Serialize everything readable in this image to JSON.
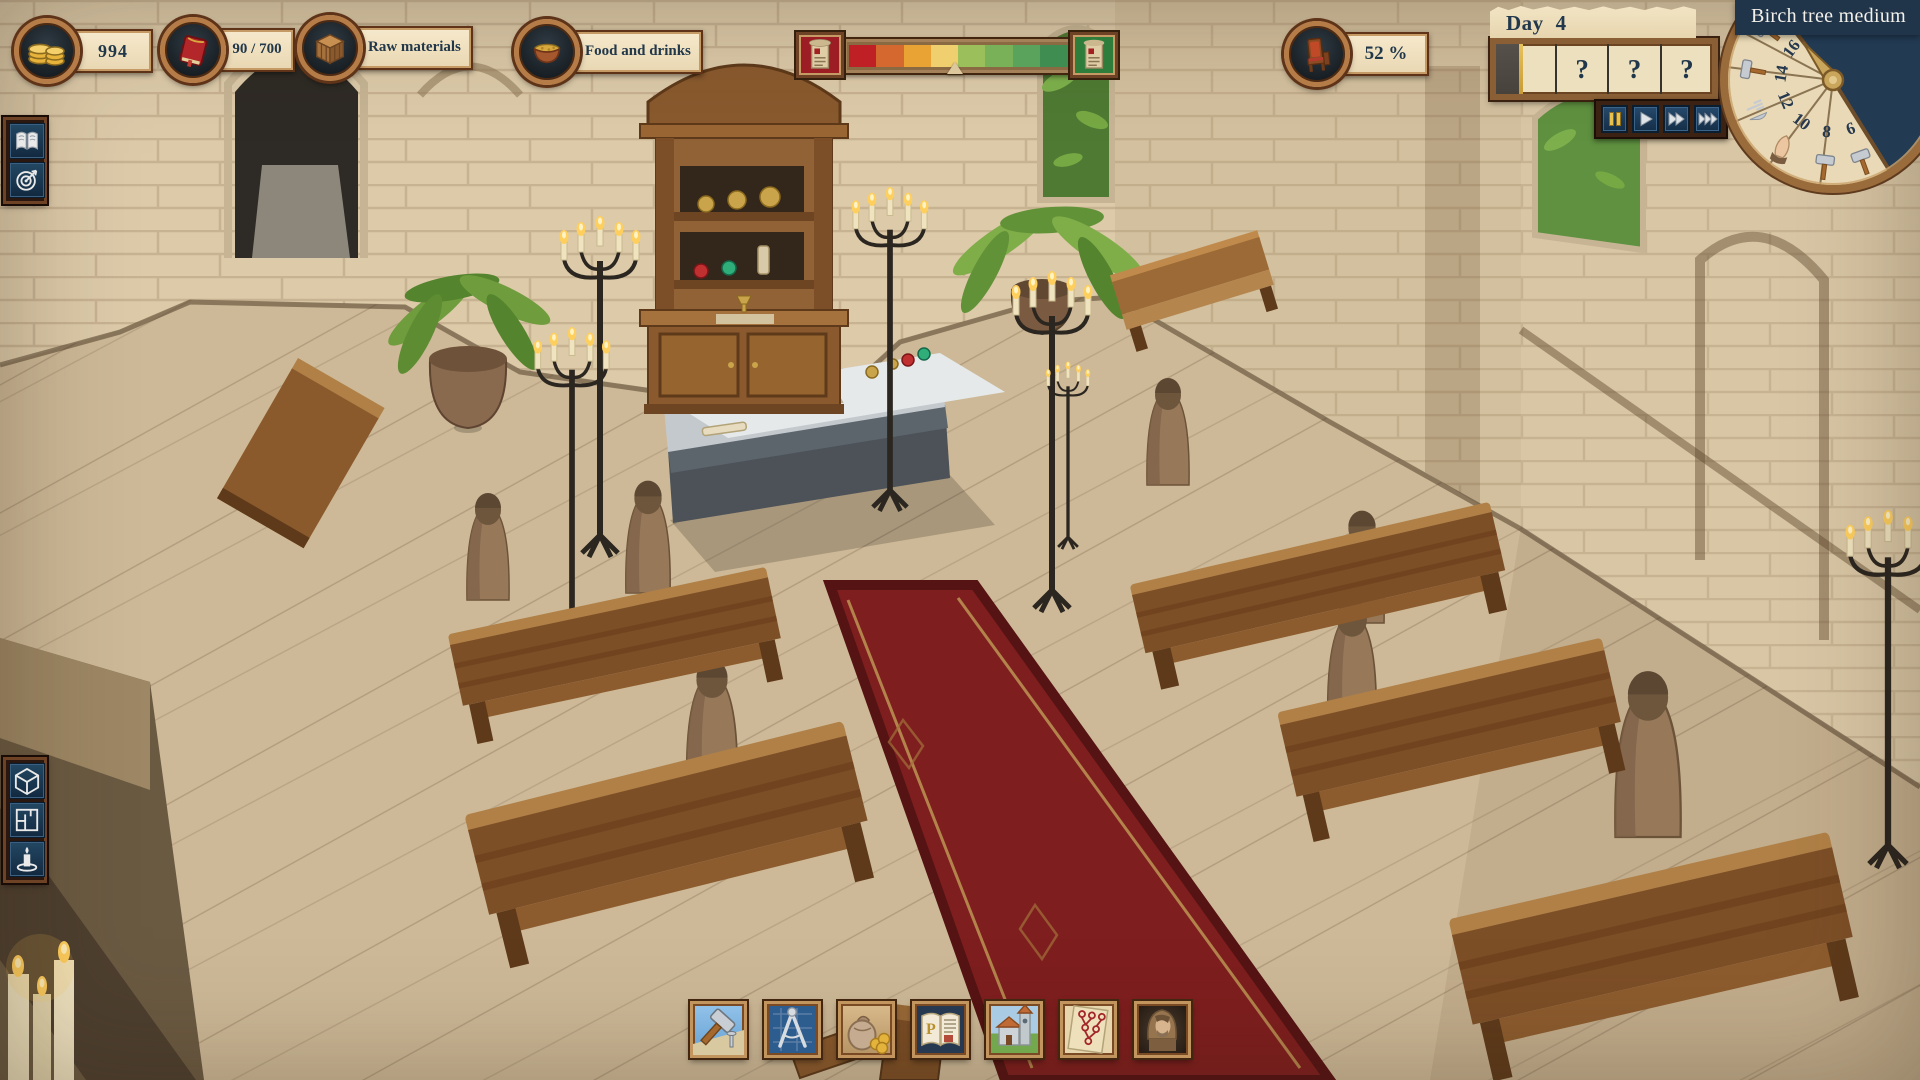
{
  "resources": {
    "gold": "994",
    "books": "90 / 700",
    "raw_materials": "Raw materials",
    "food_drinks": "Food and drinks"
  },
  "approval": {
    "value": "52 %"
  },
  "reputation": {
    "segment_colors": [
      "#bf2026",
      "#d4682e",
      "#e9a335",
      "#f0cf6e",
      "#9bbf5b",
      "#78b157",
      "#5aa35c",
      "#3f8d51"
    ],
    "marker_pct": 48.5
  },
  "day_panel": {
    "label": "Day",
    "value": "4",
    "slots": [
      "?",
      "?",
      "?"
    ]
  },
  "time_controls": {
    "buttons": [
      "pause",
      "play",
      "fast-forward",
      "fastest"
    ]
  },
  "schedule_wheel": {
    "hours": [
      "16",
      "14",
      "12",
      "10",
      "8",
      "6"
    ],
    "activities": [
      "work",
      "work",
      "meal",
      "prayer",
      "work",
      "work"
    ]
  },
  "tooltip": {
    "text": "Birch tree medium"
  },
  "left_top_toolbar": {
    "items": [
      "journal",
      "objectives"
    ]
  },
  "left_bottom_toolbar": {
    "items": [
      "place-object",
      "room-planning",
      "lighting"
    ]
  },
  "bottom_toolbar": {
    "items": [
      "construction",
      "blueprints",
      "trade",
      "scriptorium",
      "church",
      "research",
      "monks"
    ],
    "scriptorium_monogram": "P"
  },
  "colors": {
    "bronze": "#b57c47",
    "parchment": "#ece0be",
    "ui_navy": "#1d3a52",
    "night": "#223a52",
    "carpet": "#7e1e1e",
    "text": "#21374a",
    "gold": "#e7c25a"
  }
}
